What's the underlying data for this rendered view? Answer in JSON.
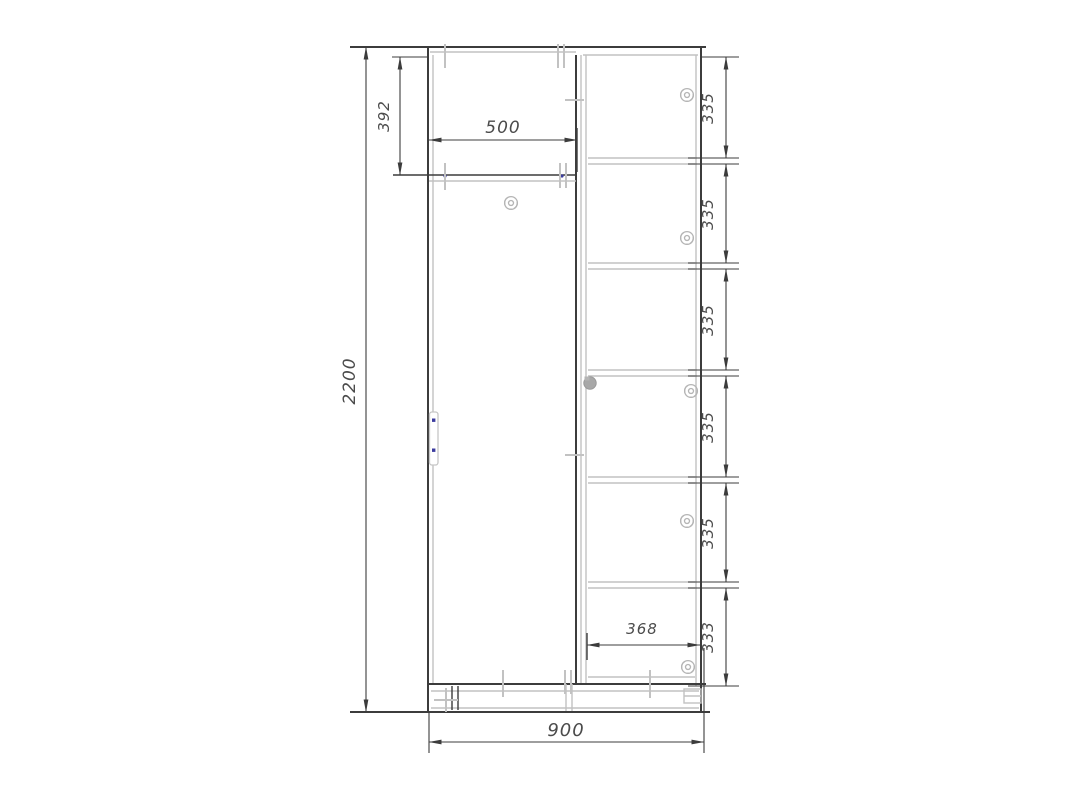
{
  "drawing_type": "wardrobe-front-elevation-technical-drawing",
  "dims": {
    "overall_height": "2200",
    "overall_width": "900",
    "top_section_height": "392",
    "left_door_width": "500",
    "right_inner_width": "368",
    "right_sections": [
      "335",
      "335",
      "335",
      "335",
      "335",
      "333"
    ]
  },
  "icons": {
    "fastener": "cam-lock-fastener-icon",
    "knob": "shelf-knob-icon",
    "handle": "door-handle"
  },
  "colors": {
    "line_dark": "#3c3c3c",
    "line_light": "#c2c2c2",
    "dim_text": "#4b4b4b",
    "screw_dot": "#3b3b9e",
    "background": "#ffffff"
  }
}
